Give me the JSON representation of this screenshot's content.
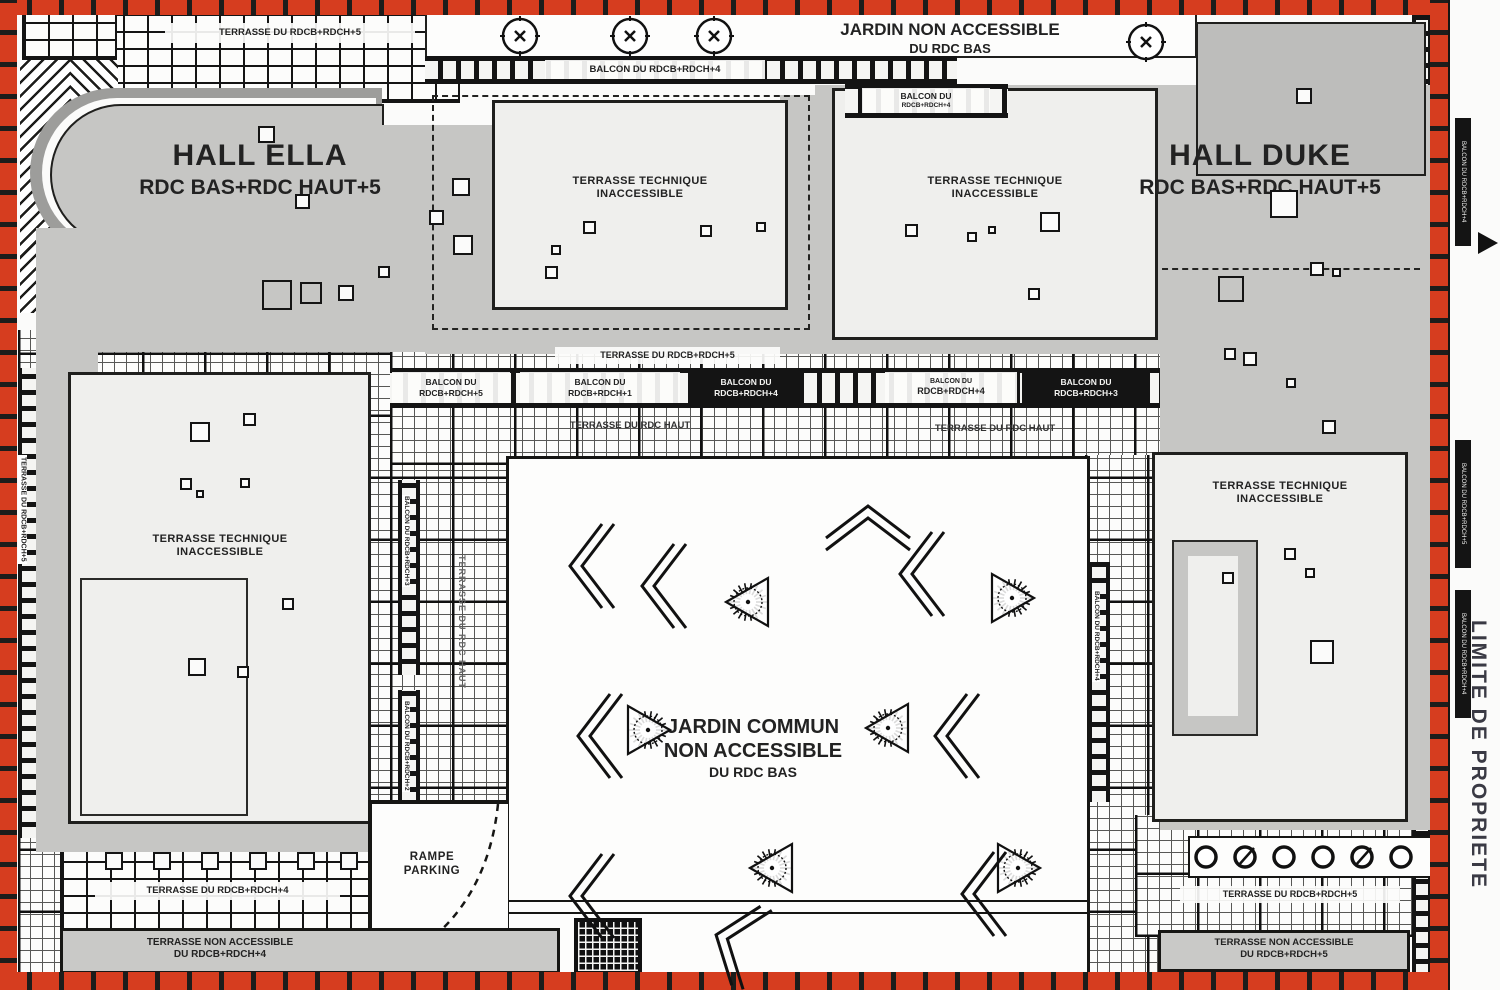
{
  "colors": {
    "boundary_red": "#d63d1f",
    "building_gray": "#c6c6c4",
    "block_white": "#efefed",
    "line_dark": "#1c1c1a"
  },
  "halls": {
    "ella": {
      "name": "HALL ELLA",
      "floors": "RDC BAS+RDC HAUT+5"
    },
    "duke": {
      "name": "HALL DUKE",
      "floors": "RDC BAS+RDC HAUT+5"
    }
  },
  "gardens": {
    "north": {
      "line1": "JARDIN NON ACCESSIBLE",
      "line2": "DU RDC BAS"
    },
    "central": {
      "line1": "JARDIN COMMUN",
      "line2": "NON ACCESSIBLE",
      "line3": "DU RDC BAS"
    }
  },
  "technical_terrace": {
    "line1": "TERRASSE TECHNIQUE",
    "line2": "INACCESSIBLE"
  },
  "ramp": {
    "line1": "RAMPE",
    "line2": "PARKING"
  },
  "boundary_label": "LIMITE DE PROPRIETE",
  "bands": {
    "top_left_terrace": "TERRASSE DU RDCB+RDCH+5",
    "north_balcony": "BALCON DU RDCB+RDCH+4",
    "north_balcony_small_l1": "BALCON DU",
    "north_balcony_small_l2": "RDCB+RDCH+4",
    "mid_terrace": "TERRASSE DU RDCB+RDCH+5",
    "balcony_5_l1": "BALCON DU",
    "balcony_5_l2": "RDCB+RDCH+5",
    "balcony_1_l1": "BALCON DU",
    "balcony_1_l2": "RDCB+RDCH+1",
    "balcony_4a_l1": "BALCON DU",
    "balcony_4a_l2": "RDCB+RDCH+4",
    "balcony_4b_l1": "BALCON DU",
    "balcony_4b_l2": "RDCB+RDCH+4",
    "balcony_3_l1": "BALCON DU",
    "balcony_3_l2": "RDCB+RDCH+3",
    "terrace_rdc_haut_west": "TERRASSE DU RDC HAUT",
    "terrace_rdc_haut_east": "TERRASSE DU RDC HAUT",
    "terrace_rdc_haut_vertical": "TERRASSE DU RDC HAUT",
    "left_edge_terrace": "TERRASSE DU RDCB+RDCH+5",
    "bottom_left_terrace": "TERRASSE DU RDCB+RDCH+4",
    "bottom_left_na_l1": "TERRASSE NON ACCESSIBLE",
    "bottom_left_na_l2": "DU RDCB+RDCH+4",
    "bottom_right_terrace": "TERRASSE DU RDCB+RDCH+5",
    "bottom_right_na_l1": "TERRASSE NON ACCESSIBLE",
    "bottom_right_na_l2": "DU RDCB+RDCH+5",
    "right_edge_balcony_a": "BALCON DU RDCB+RDCH+4",
    "right_edge_balcony_b": "BALCON DU RDCB+RDCH+5",
    "right_edge_balcony_c": "BALCON DU RDCB+RDCH+4",
    "inner_balcony_v1": "BALCON DU RDCB+RDCH+3",
    "inner_balcony_v2": "BALCON DU RDCB+RDCH+2",
    "inner_balcony_v3": "BALCON DU RDCB+RDCH+4"
  }
}
